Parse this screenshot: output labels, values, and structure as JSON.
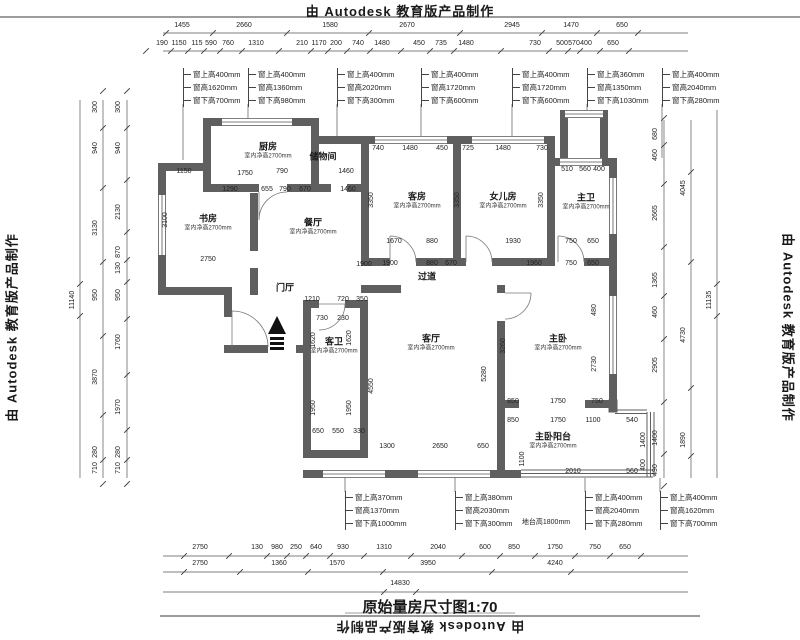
{
  "stamp": {
    "top": "由 Autodesk 教育版产品制作",
    "bottom": "由 Autodesk 教育版产品制作",
    "left": "由 Autodesk 教育版产品制作",
    "right": "由 Autodesk 教育版产品制作"
  },
  "title": {
    "text": "原始量房尺寸图1:70"
  },
  "colors": {
    "wall": "#5f5f5f",
    "line": "#3a3a3a",
    "text": "#1a1a1a"
  },
  "rooms": [
    {
      "n": "厨房",
      "s": "室内净高2700mm",
      "x": 268,
      "y": 152
    },
    {
      "n": "储物间",
      "s": "",
      "x": 323,
      "y": 157
    },
    {
      "n": "书房",
      "s": "室内净高2700mm",
      "x": 208,
      "y": 224
    },
    {
      "n": "餐厅",
      "s": "室内净高2700mm",
      "x": 313,
      "y": 228
    },
    {
      "n": "客房",
      "s": "室内净高2700mm",
      "x": 417,
      "y": 202
    },
    {
      "n": "女儿房",
      "s": "室内净高2700mm",
      "x": 503,
      "y": 202
    },
    {
      "n": "主卫",
      "s": "室内净高2700mm",
      "x": 586,
      "y": 203
    },
    {
      "n": "过道",
      "s": "",
      "x": 427,
      "y": 277
    },
    {
      "n": "门厅",
      "s": "",
      "x": 285,
      "y": 288
    },
    {
      "n": "客卫",
      "s": "室内净高2700mm",
      "x": 334,
      "y": 347
    },
    {
      "n": "客厅",
      "s": "室内净高2700mm",
      "x": 431,
      "y": 344
    },
    {
      "n": "主卧",
      "s": "室内净高2700mm",
      "x": 558,
      "y": 344
    },
    {
      "n": "主卧阳台",
      "s": "室内净高2700mm",
      "x": 553,
      "y": 442
    }
  ],
  "callouts": {
    "top": [
      {
        "x": 183,
        "y": 68,
        "lines": [
          "窗上高400mm",
          "窗高1620mm",
          "窗下高700mm"
        ]
      },
      {
        "x": 248,
        "y": 68,
        "lines": [
          "窗上高400mm",
          "窗高1360mm",
          "窗下高980mm"
        ]
      },
      {
        "x": 337,
        "y": 68,
        "lines": [
          "窗上高400mm",
          "窗高2020mm",
          "窗下高300mm"
        ]
      },
      {
        "x": 421,
        "y": 68,
        "lines": [
          "窗上高400mm",
          "窗高1720mm",
          "窗下高600mm"
        ]
      },
      {
        "x": 512,
        "y": 68,
        "lines": [
          "窗上高400mm",
          "窗高1720mm",
          "窗下高600mm"
        ]
      },
      {
        "x": 587,
        "y": 68,
        "lines": [
          "窗上高360mm",
          "窗高1350mm",
          "窗下高1030mm"
        ]
      },
      {
        "x": 662,
        "y": 68,
        "lines": [
          "窗上高400mm",
          "窗高2040mm",
          "窗下高280mm"
        ]
      }
    ],
    "bottom": [
      {
        "x": 345,
        "y": 491,
        "lines": [
          "窗上高370mm",
          "窗高1370mm",
          "窗下高1000mm"
        ]
      },
      {
        "x": 455,
        "y": 491,
        "lines": [
          "窗上高380mm",
          "窗高2030mm",
          "窗下高300mm"
        ]
      },
      {
        "x": 585,
        "y": 491,
        "lines": [
          "窗上高400mm",
          "窗高2040mm",
          "窗下高280mm"
        ]
      },
      {
        "x": 660,
        "y": 491,
        "lines": [
          "窗上高400mm",
          "窗高1620mm",
          "窗下高700mm"
        ]
      }
    ]
  },
  "dims": {
    "top1": [
      {
        "t": "1455",
        "x": 182,
        "y": 26
      },
      {
        "t": "2660",
        "x": 244,
        "y": 26
      },
      {
        "t": "1580",
        "x": 330,
        "y": 26
      },
      {
        "t": "2670",
        "x": 407,
        "y": 26
      },
      {
        "t": "2945",
        "x": 512,
        "y": 26
      },
      {
        "t": "1470",
        "x": 571,
        "y": 26
      },
      {
        "t": "650",
        "x": 622,
        "y": 26
      }
    ],
    "top2": [
      {
        "t": "190",
        "x": 162,
        "y": 44
      },
      {
        "t": "1150",
        "x": 179,
        "y": 44
      },
      {
        "t": "115",
        "x": 197,
        "y": 44
      },
      {
        "t": "590",
        "x": 211,
        "y": 44
      },
      {
        "t": "760",
        "x": 228,
        "y": 44
      },
      {
        "t": "1310",
        "x": 256,
        "y": 44
      },
      {
        "t": "210",
        "x": 302,
        "y": 44
      },
      {
        "t": "1170",
        "x": 319,
        "y": 44
      },
      {
        "t": "200",
        "x": 336,
        "y": 44
      },
      {
        "t": "740",
        "x": 358,
        "y": 44
      },
      {
        "t": "1480",
        "x": 382,
        "y": 44
      },
      {
        "t": "450",
        "x": 419,
        "y": 44
      },
      {
        "t": "735",
        "x": 441,
        "y": 44
      },
      {
        "t": "1480",
        "x": 466,
        "y": 44
      },
      {
        "t": "730",
        "x": 535,
        "y": 44
      },
      {
        "t": "500",
        "x": 562,
        "y": 44
      },
      {
        "t": "570",
        "x": 574,
        "y": 44
      },
      {
        "t": "400",
        "x": 586,
        "y": 44
      },
      {
        "t": "650",
        "x": 613,
        "y": 44
      }
    ],
    "bottomA": [
      {
        "t": "2750",
        "x": 200,
        "y": 548
      },
      {
        "t": "130",
        "x": 257,
        "y": 548
      },
      {
        "t": "980",
        "x": 277,
        "y": 548
      },
      {
        "t": "250",
        "x": 296,
        "y": 548
      },
      {
        "t": "640",
        "x": 316,
        "y": 548
      },
      {
        "t": "930",
        "x": 343,
        "y": 548
      },
      {
        "t": "1310",
        "x": 384,
        "y": 548
      },
      {
        "t": "2040",
        "x": 438,
        "y": 548
      },
      {
        "t": "600",
        "x": 485,
        "y": 548
      },
      {
        "t": "850",
        "x": 514,
        "y": 548
      },
      {
        "t": "1750",
        "x": 555,
        "y": 548
      },
      {
        "t": "750",
        "x": 595,
        "y": 548
      },
      {
        "t": "650",
        "x": 625,
        "y": 548
      }
    ],
    "bottomB": [
      {
        "t": "2750",
        "x": 200,
        "y": 564
      },
      {
        "t": "1360",
        "x": 279,
        "y": 564
      },
      {
        "t": "1570",
        "x": 337,
        "y": 564
      },
      {
        "t": "3950",
        "x": 428,
        "y": 564
      },
      {
        "t": "4240",
        "x": 555,
        "y": 564
      }
    ],
    "bottomC": [
      {
        "t": "14830",
        "x": 400,
        "y": 584
      }
    ],
    "left1": [
      {
        "t": "11140",
        "x": 73,
        "y": 300,
        "r": 1
      }
    ],
    "left2": [
      {
        "t": "300",
        "x": 96,
        "y": 107,
        "r": 1
      },
      {
        "t": "940",
        "x": 96,
        "y": 148,
        "r": 1
      },
      {
        "t": "3130",
        "x": 96,
        "y": 228,
        "r": 1
      },
      {
        "t": "950",
        "x": 96,
        "y": 295,
        "r": 1
      },
      {
        "t": "3870",
        "x": 96,
        "y": 377,
        "r": 1
      },
      {
        "t": "280",
        "x": 96,
        "y": 452,
        "r": 1
      },
      {
        "t": "710",
        "x": 96,
        "y": 468,
        "r": 1
      }
    ],
    "left3": [
      {
        "t": "300",
        "x": 119,
        "y": 107,
        "r": 1
      },
      {
        "t": "940",
        "x": 119,
        "y": 148,
        "r": 1
      },
      {
        "t": "2130",
        "x": 119,
        "y": 212,
        "r": 1
      },
      {
        "t": "870",
        "x": 119,
        "y": 252,
        "r": 1
      },
      {
        "t": "130",
        "x": 119,
        "y": 268,
        "r": 1
      },
      {
        "t": "950",
        "x": 119,
        "y": 295,
        "r": 1
      },
      {
        "t": "1760",
        "x": 119,
        "y": 342,
        "r": 1
      },
      {
        "t": "1970",
        "x": 119,
        "y": 407,
        "r": 1
      },
      {
        "t": "280",
        "x": 119,
        "y": 452,
        "r": 1
      },
      {
        "t": "710",
        "x": 119,
        "y": 468,
        "r": 1
      }
    ],
    "right1": [
      {
        "t": "680",
        "x": 656,
        "y": 134,
        "r": 1
      },
      {
        "t": "460",
        "x": 656,
        "y": 155,
        "r": 1
      },
      {
        "t": "2665",
        "x": 656,
        "y": 213,
        "r": 1
      },
      {
        "t": "1365",
        "x": 656,
        "y": 280,
        "r": 1
      },
      {
        "t": "460",
        "x": 656,
        "y": 312,
        "r": 1
      },
      {
        "t": "2905",
        "x": 656,
        "y": 365,
        "r": 1
      },
      {
        "t": "1400",
        "x": 656,
        "y": 438,
        "r": 1
      },
      {
        "t": "490",
        "x": 656,
        "y": 470,
        "r": 1
      }
    ],
    "right2": [
      {
        "t": "4045",
        "x": 684,
        "y": 188,
        "r": 1
      },
      {
        "t": "4730",
        "x": 684,
        "y": 335,
        "r": 1
      },
      {
        "t": "1890",
        "x": 684,
        "y": 440,
        "r": 1
      }
    ],
    "right3": [
      {
        "t": "11135",
        "x": 710,
        "y": 300,
        "r": 1
      }
    ],
    "interior": [
      {
        "t": "1150",
        "x": 184,
        "y": 172
      },
      {
        "t": "1750",
        "x": 245,
        "y": 174
      },
      {
        "t": "790",
        "x": 282,
        "y": 172
      },
      {
        "t": "1460",
        "x": 346,
        "y": 172
      },
      {
        "t": "1290",
        "x": 230,
        "y": 190
      },
      {
        "t": "655",
        "x": 267,
        "y": 190
      },
      {
        "t": "790",
        "x": 285,
        "y": 190
      },
      {
        "t": "670",
        "x": 305,
        "y": 190
      },
      {
        "t": "1460",
        "x": 348,
        "y": 190
      },
      {
        "t": "2750",
        "x": 208,
        "y": 260
      },
      {
        "t": "1900",
        "x": 364,
        "y": 265
      },
      {
        "t": "3100",
        "x": 166,
        "y": 220,
        "r": 1
      },
      {
        "t": "740",
        "x": 378,
        "y": 149
      },
      {
        "t": "1480",
        "x": 410,
        "y": 149
      },
      {
        "t": "450",
        "x": 442,
        "y": 149
      },
      {
        "t": "725",
        "x": 468,
        "y": 149
      },
      {
        "t": "1480",
        "x": 503,
        "y": 149
      },
      {
        "t": "730",
        "x": 542,
        "y": 149
      },
      {
        "t": "510",
        "x": 567,
        "y": 170
      },
      {
        "t": "560",
        "x": 585,
        "y": 170
      },
      {
        "t": "400",
        "x": 599,
        "y": 170
      },
      {
        "t": "3350",
        "x": 372,
        "y": 200,
        "r": 1
      },
      {
        "t": "3350",
        "x": 458,
        "y": 200,
        "r": 1
      },
      {
        "t": "3350",
        "x": 542,
        "y": 200,
        "r": 1
      },
      {
        "t": "1670",
        "x": 394,
        "y": 242
      },
      {
        "t": "880",
        "x": 432,
        "y": 242
      },
      {
        "t": "1930",
        "x": 513,
        "y": 242
      },
      {
        "t": "750",
        "x": 571,
        "y": 242
      },
      {
        "t": "650",
        "x": 593,
        "y": 242
      },
      {
        "t": "1900",
        "x": 390,
        "y": 264
      },
      {
        "t": "880",
        "x": 432,
        "y": 264
      },
      {
        "t": "670",
        "x": 451,
        "y": 264
      },
      {
        "t": "1960",
        "x": 534,
        "y": 264
      },
      {
        "t": "750",
        "x": 571,
        "y": 264
      },
      {
        "t": "650",
        "x": 593,
        "y": 264
      },
      {
        "t": "1210",
        "x": 312,
        "y": 300
      },
      {
        "t": "720",
        "x": 343,
        "y": 300
      },
      {
        "t": "350",
        "x": 362,
        "y": 300
      },
      {
        "t": "730",
        "x": 322,
        "y": 319
      },
      {
        "t": "230",
        "x": 343,
        "y": 319
      },
      {
        "t": "1620",
        "x": 314,
        "y": 340,
        "r": 1
      },
      {
        "t": "1620",
        "x": 350,
        "y": 338,
        "r": 1
      },
      {
        "t": "1950",
        "x": 314,
        "y": 408,
        "r": 1
      },
      {
        "t": "1950",
        "x": 350,
        "y": 408,
        "r": 1
      },
      {
        "t": "650",
        "x": 318,
        "y": 432
      },
      {
        "t": "550",
        "x": 338,
        "y": 432
      },
      {
        "t": "330",
        "x": 359,
        "y": 432
      },
      {
        "t": "1300",
        "x": 387,
        "y": 447
      },
      {
        "t": "2650",
        "x": 440,
        "y": 447
      },
      {
        "t": "650",
        "x": 483,
        "y": 447
      },
      {
        "t": "5280",
        "x": 485,
        "y": 374,
        "r": 1
      },
      {
        "t": "4550",
        "x": 372,
        "y": 386,
        "r": 1
      },
      {
        "t": "3260",
        "x": 504,
        "y": 346,
        "r": 1
      },
      {
        "t": "2730",
        "x": 595,
        "y": 364,
        "r": 1
      },
      {
        "t": "480",
        "x": 595,
        "y": 310,
        "r": 1
      },
      {
        "t": "850",
        "x": 513,
        "y": 402
      },
      {
        "t": "1750",
        "x": 558,
        "y": 402
      },
      {
        "t": "750",
        "x": 597,
        "y": 402
      },
      {
        "t": "850",
        "x": 513,
        "y": 421
      },
      {
        "t": "1750",
        "x": 558,
        "y": 421
      },
      {
        "t": "1100",
        "x": 593,
        "y": 421
      },
      {
        "t": "540",
        "x": 632,
        "y": 421
      },
      {
        "t": "2010",
        "x": 573,
        "y": 472
      },
      {
        "t": "560",
        "x": 632,
        "y": 472
      },
      {
        "t": "1400",
        "x": 644,
        "y": 440,
        "r": 1
      },
      {
        "t": "400",
        "x": 644,
        "y": 465,
        "r": 1
      },
      {
        "t": "1100",
        "x": 523,
        "y": 459,
        "r": 1
      },
      {
        "t": "地台高1800mm",
        "x": 546,
        "y": 523
      }
    ]
  }
}
